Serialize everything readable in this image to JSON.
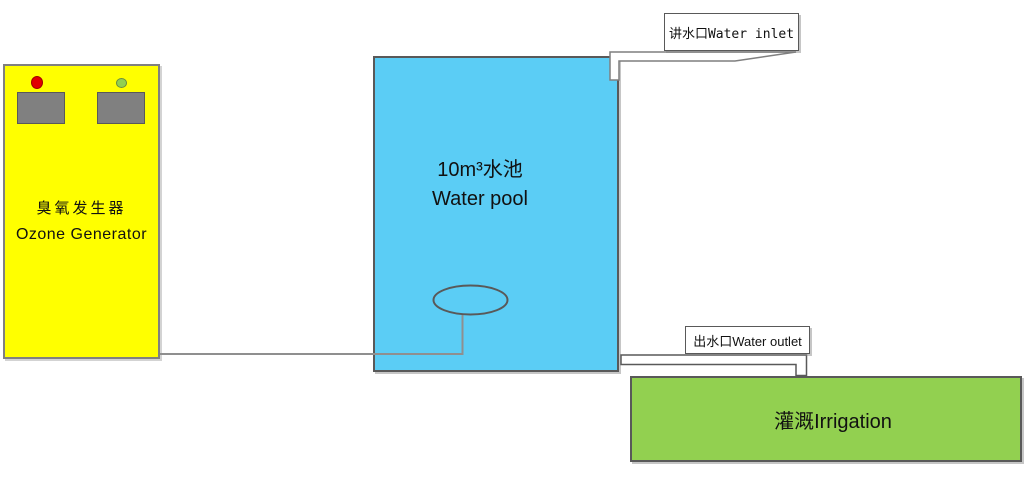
{
  "canvas": {
    "background": "#FFFFFF"
  },
  "colors": {
    "ozone_box_fill": "#FFFF00",
    "ozone_box_border": "#808080",
    "panel_gray": "#808080",
    "indicator_red": "#E10000",
    "indicator_green": "#92D050",
    "pool_fill": "#5BCDF5",
    "pool_border": "#595959",
    "irrigation_fill": "#92D050",
    "irrigation_border": "#595959",
    "pipe_fill": "#FFFFFF",
    "pipe_stroke": "#7F7F7F",
    "connector_stroke": "#8F8F8F",
    "label_box_border": "#595959"
  },
  "ozone_generator": {
    "label_cn": "臭氧发生器",
    "label_en": "Ozone Generator"
  },
  "water_pool": {
    "label_line1": "10m³水池",
    "label_line2": "Water pool"
  },
  "labels": {
    "water_inlet": "讲水口Water inlet",
    "water_outlet": "出水口Water outlet",
    "irrigation": "灌溉Irrigation"
  }
}
